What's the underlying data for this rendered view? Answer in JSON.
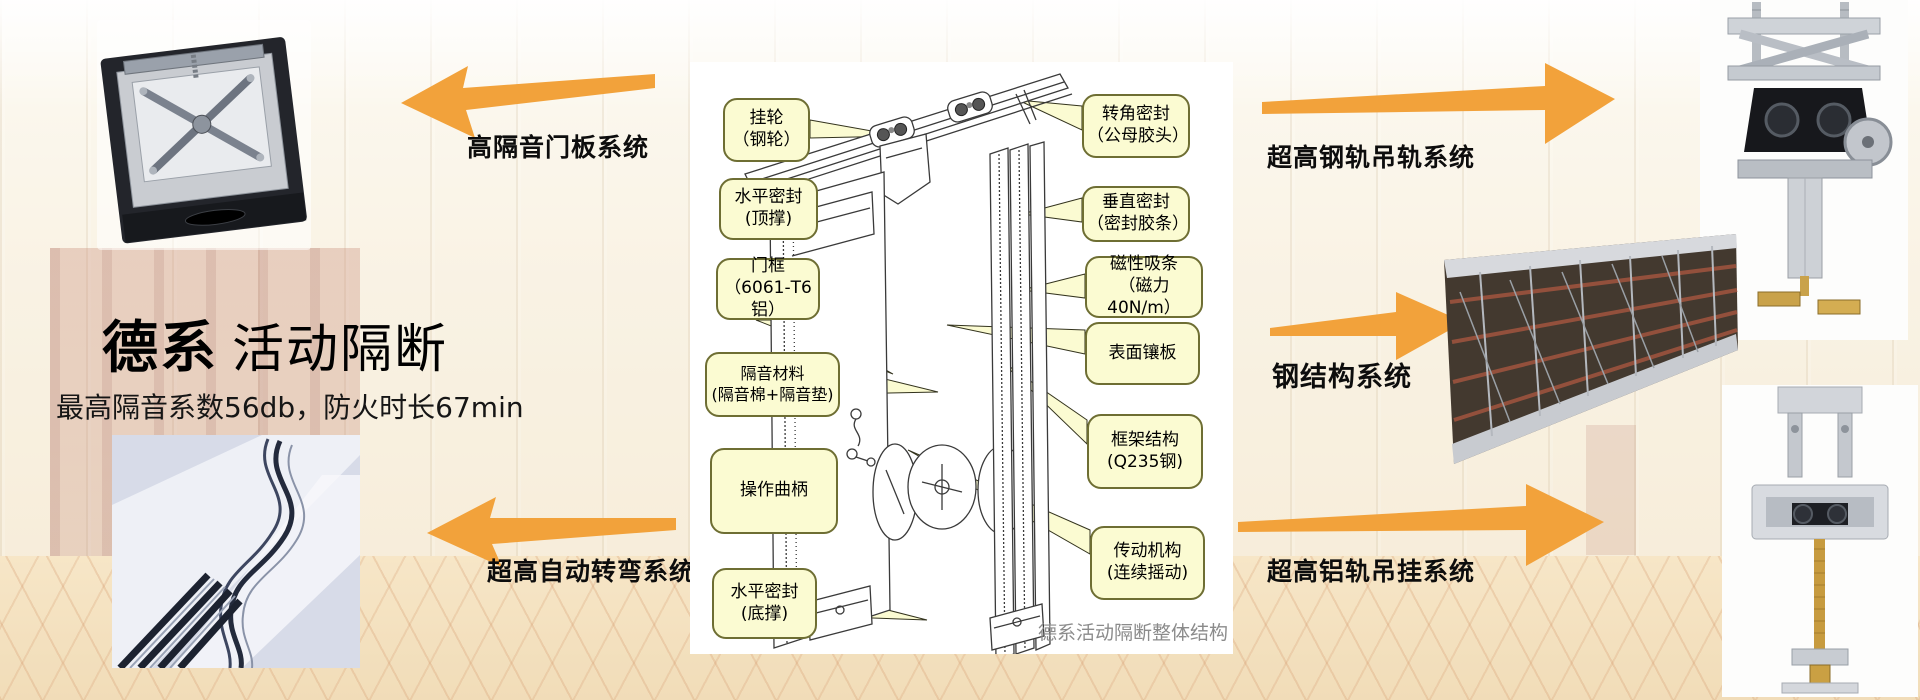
{
  "header": {
    "title_bold": "德系",
    "title_rest": "活动隔断",
    "subtitle": "最高隔音系数56db，防火时长67min"
  },
  "systems": {
    "door_panel_label": "高隔音门板系统",
    "auto_turn_label": "超高自动转弯系统",
    "steel_rail_label": "超高钢轨吊轨系统",
    "steel_structure_label": "钢结构系统",
    "alu_rail_label": "超高铝轨吊挂系统"
  },
  "diagram": {
    "caption": "德系活动隔断整体结构",
    "callouts_left": [
      {
        "line1": "挂轮",
        "line2": "（钢轮）"
      },
      {
        "line1": "水平密封",
        "line2": "(顶撑)"
      },
      {
        "line1": "门框",
        "line2": "（6061-T6铝）"
      },
      {
        "line1": "隔音材料",
        "line2": "(隔音棉+隔音垫)"
      },
      {
        "line1": "操作曲柄",
        "line2": ""
      },
      {
        "line1": "水平密封",
        "line2": "(底撑)"
      }
    ],
    "callouts_right": [
      {
        "line1": "转角密封",
        "line2": "（公母胶头）"
      },
      {
        "line1": "垂直密封",
        "line2": "（密封胶条）"
      },
      {
        "line1": "磁性吸条",
        "line2": "（磁力40N/m）"
      },
      {
        "line1": "表面镶板",
        "line2": ""
      },
      {
        "line1": "框架结构",
        "line2": "(Q235钢)"
      },
      {
        "line1": "传动机构",
        "line2": "(连续摇动)"
      }
    ]
  },
  "colors": {
    "arrow_orange": "#F2A23B",
    "callout_bg": "#FBFBD2",
    "callout_border": "#6E6E33",
    "caption_gray": "#8B8B8B"
  }
}
